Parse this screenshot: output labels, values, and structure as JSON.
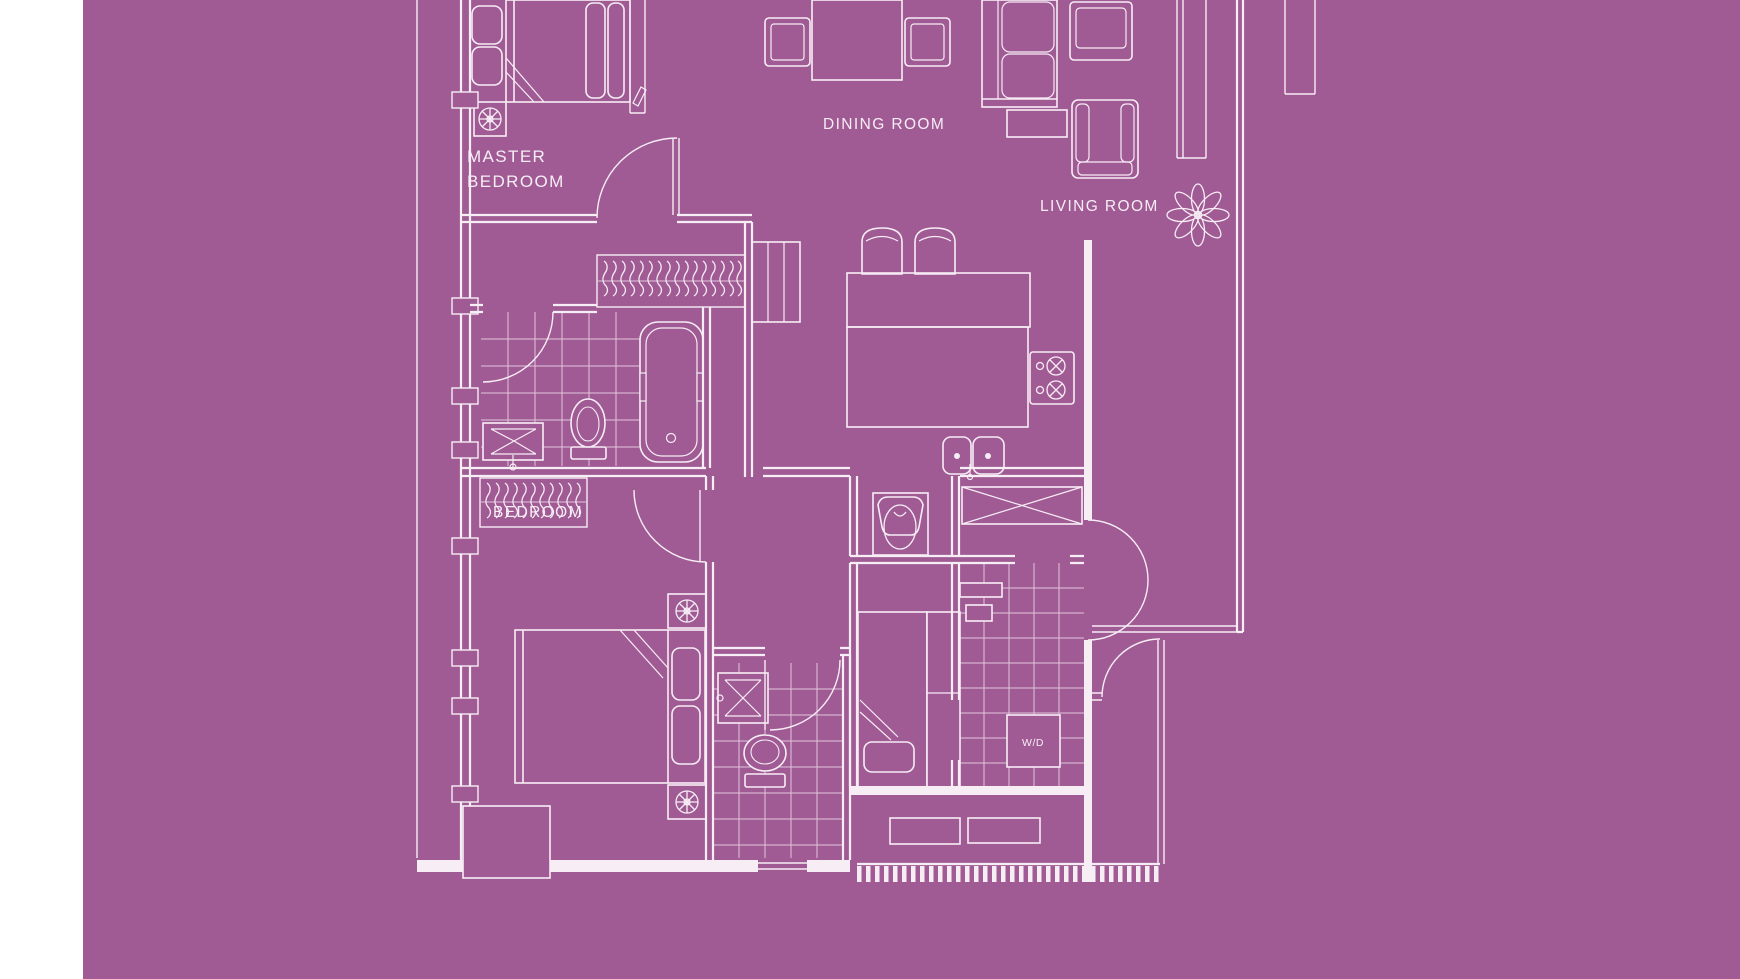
{
  "palette": {
    "background": "#a05b94",
    "line": "#f7edf5",
    "line_soft": "#e0c4db",
    "margin": "#ffffff"
  },
  "labels": {
    "master_bedroom_line1": "MASTER",
    "master_bedroom_line2": "BEDROOM",
    "dining_room": "DINING ROOM",
    "living_room": "LIVING ROOM",
    "bedroom": "BEDROOM",
    "washer_dryer": "W/D"
  }
}
